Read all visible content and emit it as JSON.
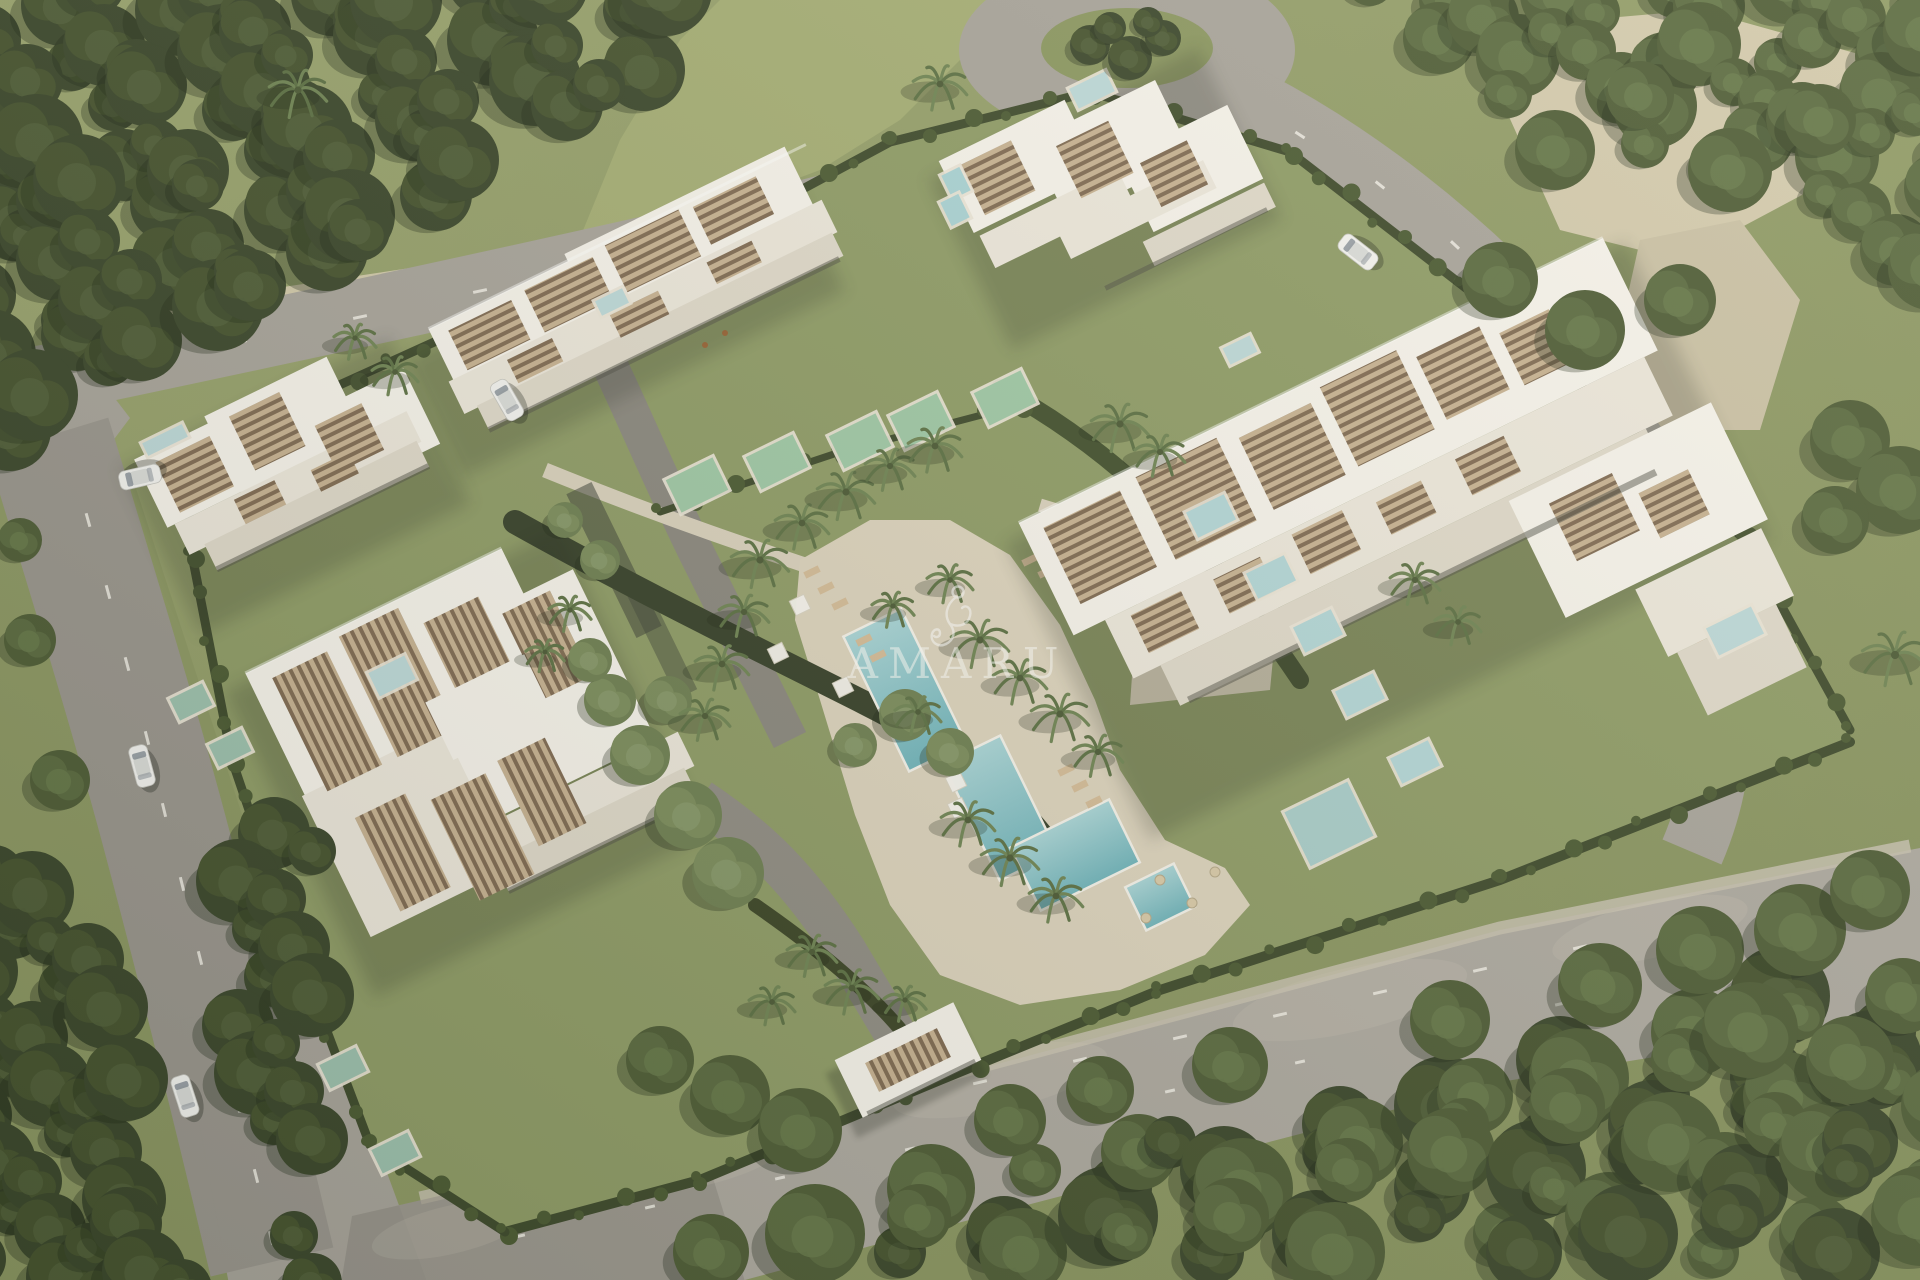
{
  "watermark": {
    "text": "AMARU",
    "logo": "amaru-monkey-logo"
  },
  "palette": {
    "grass": "#94a06a",
    "forest": "#3b472c",
    "road": "#a7a39a",
    "sand": "#d3caad",
    "building_white": "#f5f2ea",
    "slat_brown": "#7f6a52",
    "pool_turquoise": "#7fbcc2",
    "plunge_pool_green": "#9ec7a5",
    "watermark_white": "#fdfdf8"
  },
  "scene": {
    "type": "aerial-architectural-render",
    "buildings": [
      "north-apartment-block",
      "northeast-apartment-block",
      "east-apartment-block",
      "west-apartment-block",
      "southwest-apartment-block",
      "entrance-gatehouse"
    ],
    "amenities": [
      "central-lap-pool",
      "secondary-pool-terraces",
      "sun-deck",
      "cabanas",
      "private-plunge-pools",
      "rooftop-pools",
      "tropical-gardens"
    ],
    "environment": [
      "perimeter-roads",
      "roundabout",
      "dense-forest",
      "palm-trees",
      "lawns",
      "sand-clearings"
    ],
    "vehicles": {
      "white_cars": 5
    }
  }
}
